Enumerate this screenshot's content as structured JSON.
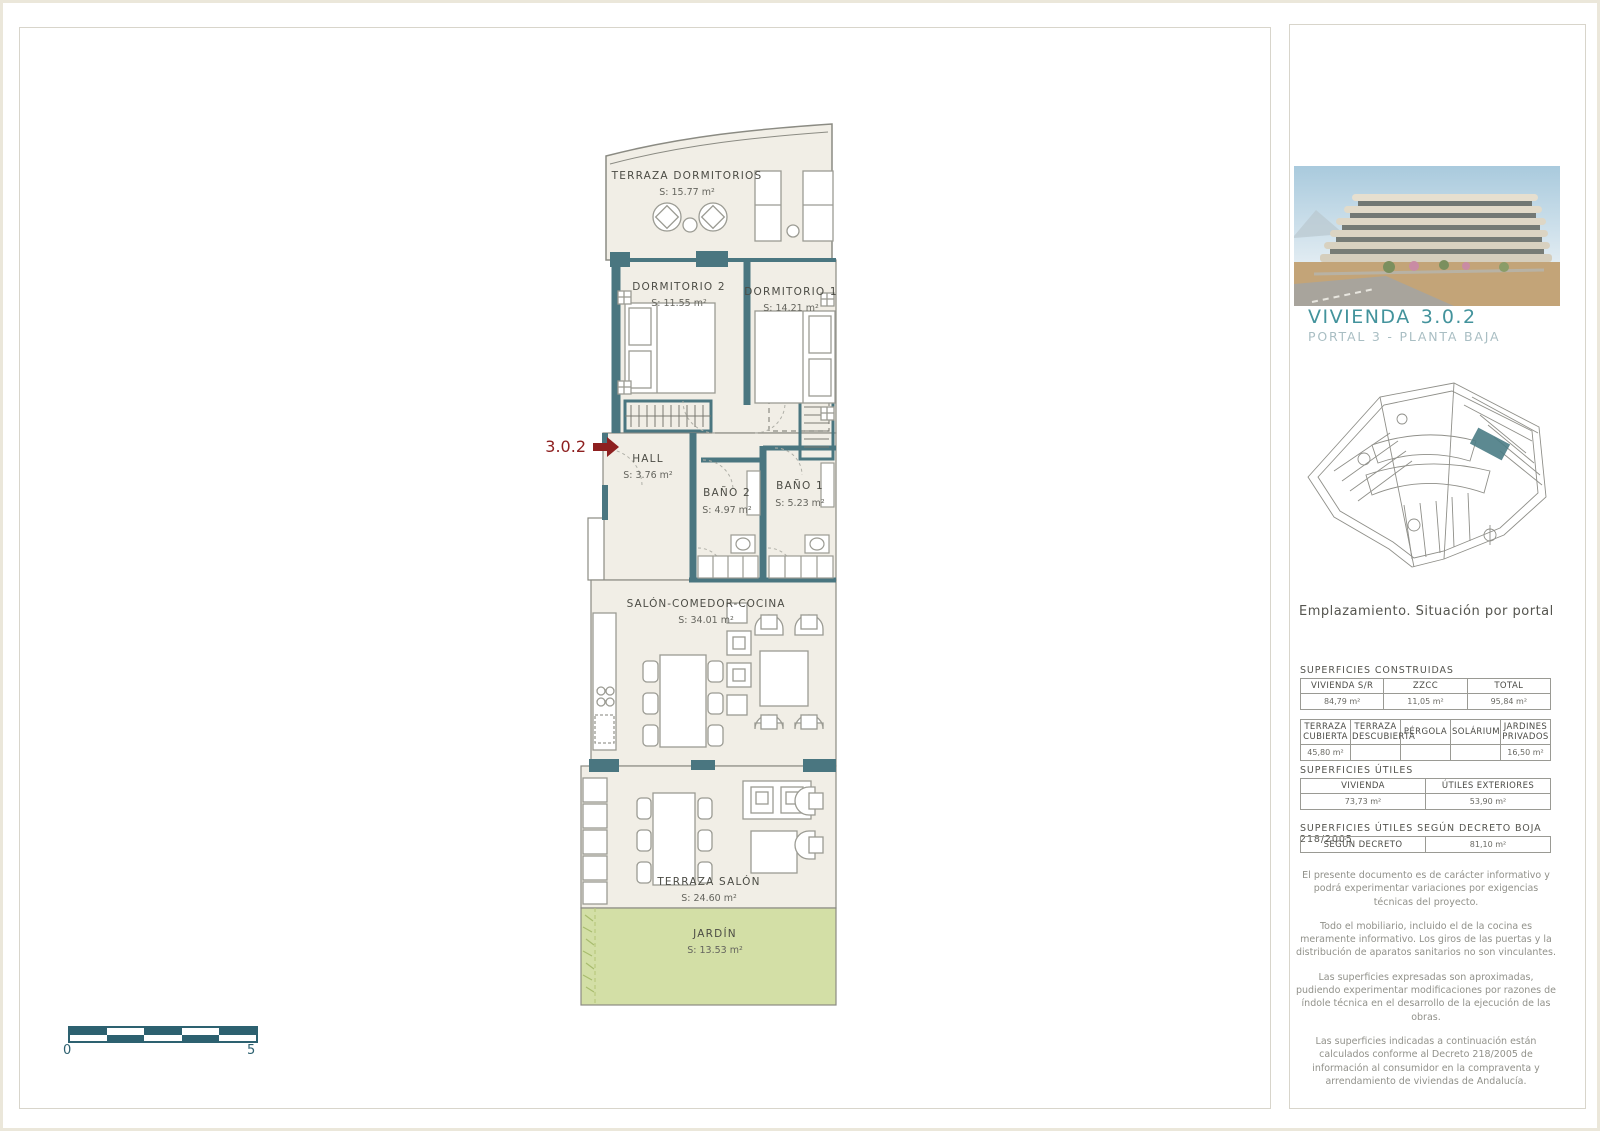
{
  "plan": {
    "unit_label": "3.0.2",
    "rooms": [
      {
        "name": "TERRAZA DORMITORIOS",
        "area": "S: 15.77 m²"
      },
      {
        "name": "DORMITORIO 2",
        "area": "S: 11.55 m²"
      },
      {
        "name": "DORMITORIO 1",
        "area": "S: 14.21 m²"
      },
      {
        "name": "HALL",
        "area": "S: 3.76 m²"
      },
      {
        "name": "BAÑO 2",
        "area": "S: 4.97 m²"
      },
      {
        "name": "BAÑO 1",
        "area": "S: 5.23 m²"
      },
      {
        "name": "SALÓN-COMEDOR-COCINA",
        "area": "S: 34.01 m²"
      },
      {
        "name": "TERRAZA SALÓN",
        "area": "S: 24.60 m²"
      },
      {
        "name": "JARDÍN",
        "area": "S: 13.53 m²"
      }
    ],
    "scale": {
      "start": "0",
      "end": "5"
    }
  },
  "sidebar": {
    "title": "VIVIENDA",
    "unit": "3.0.2",
    "subtitle": "PORTAL 3 - PLANTA BAJA",
    "siteplan_caption": "Emplazamiento. Situación por portal",
    "sections": {
      "construidas": "SUPERFICIES CONSTRUIDAS",
      "utiles": "SUPERFICIES ÚTILES",
      "decreto": "SUPERFICIES ÚTILES SEGÚN DECRETO BOJA 218/2005"
    },
    "tables": {
      "t1": {
        "headers": [
          "VIVIENDA S/R",
          "ZZCC",
          "TOTAL"
        ],
        "values": [
          "84,79 m²",
          "11,05 m²",
          "95,84 m²"
        ]
      },
      "t2": {
        "headers": [
          "TERRAZA CUBIERTA",
          "TERRAZA DESCUBIERTA",
          "PÉRGOLA",
          "SOLÁRIUM",
          "JARDINES PRIVADOS"
        ],
        "values": [
          "45,80 m²",
          "",
          "",
          "",
          "16,50 m²"
        ]
      },
      "t3": {
        "headers": [
          "VIVIENDA",
          "ÚTILES EXTERIORES"
        ],
        "values": [
          "73,73 m²",
          "53,90 m²"
        ]
      },
      "t4": {
        "header": "SEGÚN DECRETO",
        "value": "81,10 m²"
      }
    },
    "notes": [
      "El presente documento es de carácter informativo y podrá experimentar variaciones por exigencias técnicas del proyecto.",
      "Todo el mobiliario, incluido el de la cocina es meramente informativo. Los giros de las puertas y la distribución de aparatos sanitarios no son vinculantes.",
      "Las superficies expresadas son aproximadas, pudiendo experimentar modificaciones por razones de índole técnica en el desarrollo de la ejecución de las obras.",
      "Las superficies indicadas a continuación están calculados conforme al Decreto 218/2005 de información al consumidor en la compraventa y arrendamiento de viviendas de Andalucía."
    ]
  },
  "colors": {
    "wall_teal": "#4a7680",
    "accent_teal": "#3e6f7a",
    "floor_beige": "#f1eee6",
    "garden_green": "#d3dfa6",
    "arrow_red": "#8e2020",
    "scale_teal": "#2d6170",
    "title_teal": "#43939c"
  }
}
